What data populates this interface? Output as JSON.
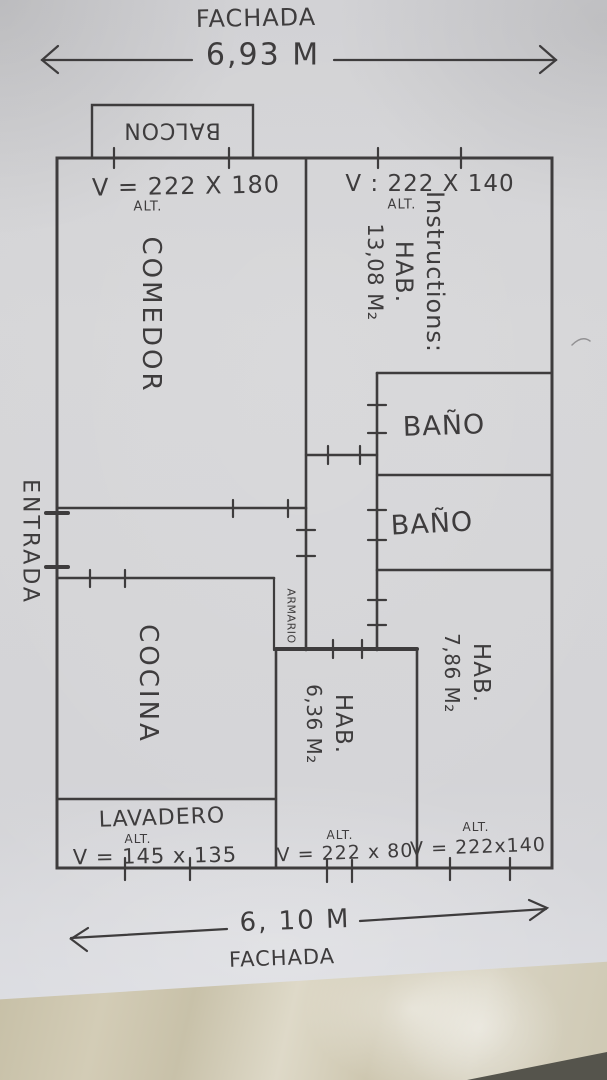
{
  "top": {
    "facade": "FACHADA",
    "width": "6,93 M"
  },
  "bottom": {
    "facade": "FACHADA",
    "width": "6, 10 M"
  },
  "left": {
    "entrance": "ENTRADA"
  },
  "balcony": {
    "label": "BALCON"
  },
  "rooms": {
    "comedor": {
      "name": "COMEDOR",
      "alt": "ALT.",
      "window": "V = 222 X 180"
    },
    "hab_13": {
      "name": "HAB.",
      "area": "13,08 M₂",
      "alt": "ALT.",
      "window": "V : 222 X 140"
    },
    "bano_1": {
      "name": "BAÑO"
    },
    "bano_2": {
      "name": "BAÑO"
    },
    "cocina": {
      "name": "COCINA"
    },
    "armario": {
      "name": "ARMARIO"
    },
    "hab_6": {
      "name": "HAB.",
      "area": "6,36 M₂",
      "alt": "ALT.",
      "window": "V = 222 x 80"
    },
    "hab_7": {
      "name": "HAB.",
      "area": "7,86 M₂",
      "alt": "ALT.",
      "window": "V = 222x140"
    },
    "lavadero": {
      "name": "LAVADERO",
      "alt": "ALT.",
      "window": "V = 145 x 135"
    }
  },
  "colors": {
    "ink": "#3e3c3d",
    "paper": "#d4d4d6",
    "table": "#cfc8b2"
  }
}
